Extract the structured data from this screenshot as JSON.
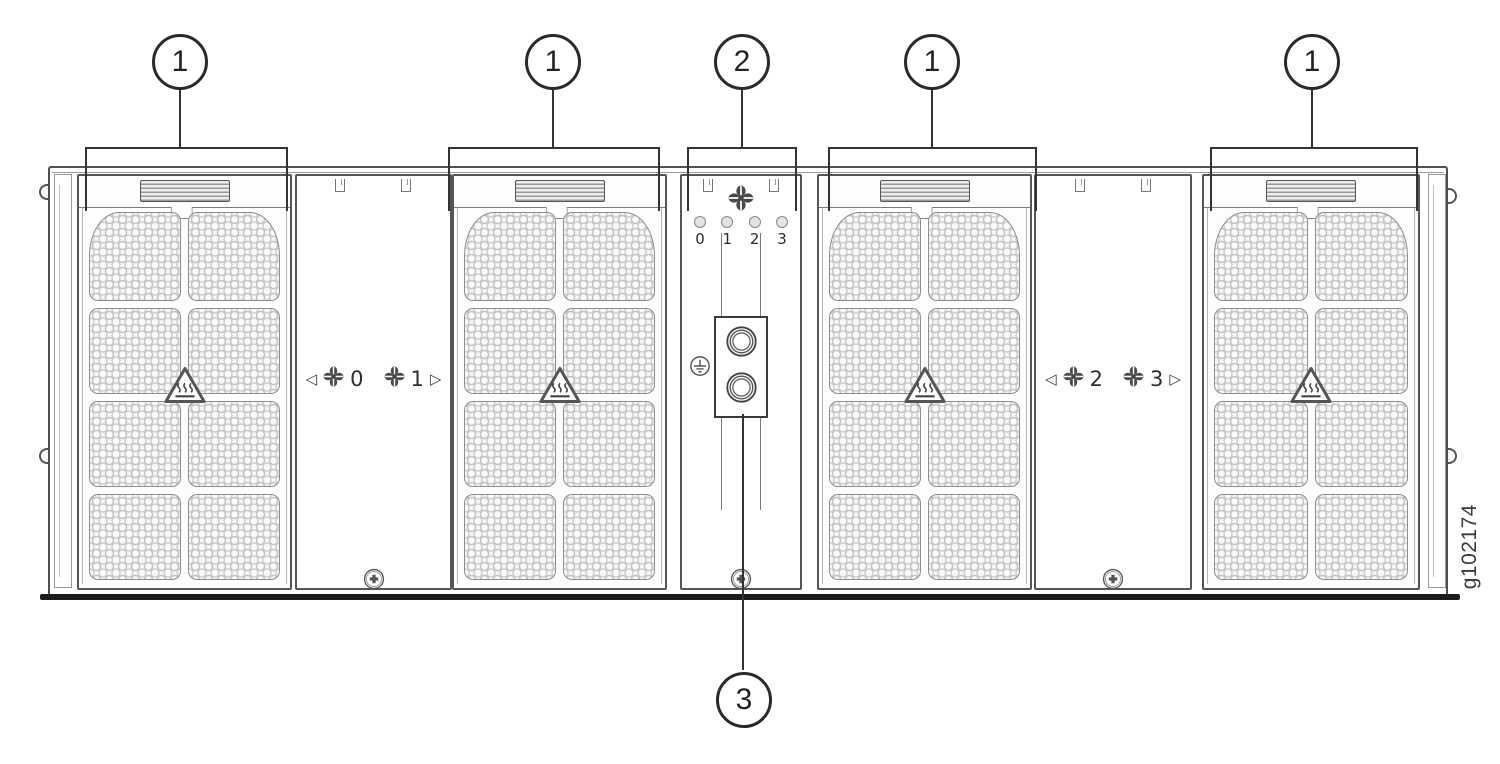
{
  "figure": {
    "id": "g102174"
  },
  "callouts": {
    "top": [
      "1",
      "1",
      "2",
      "1",
      "1"
    ],
    "bottom": "3"
  },
  "center_panel": {
    "led_labels": [
      "0",
      "1",
      "2",
      "3"
    ]
  },
  "fan_bays": [
    {
      "arrow_left": "◁",
      "fan_a": "0",
      "fan_b": "1",
      "arrow_right": "▷"
    },
    {
      "arrow_left": "◁",
      "fan_a": "2",
      "fan_b": "3",
      "arrow_right": "▷"
    }
  ],
  "icons": {
    "fan": "pinwheel-fan-icon",
    "hot_surface": "hot-surface-warning-icon",
    "ground": "earth-ground-icon",
    "screw": "phillips-screw-icon"
  },
  "colors": {
    "line": "#333333",
    "led_fill": "#e3e3e3",
    "mesh": "#c6c6c6"
  }
}
